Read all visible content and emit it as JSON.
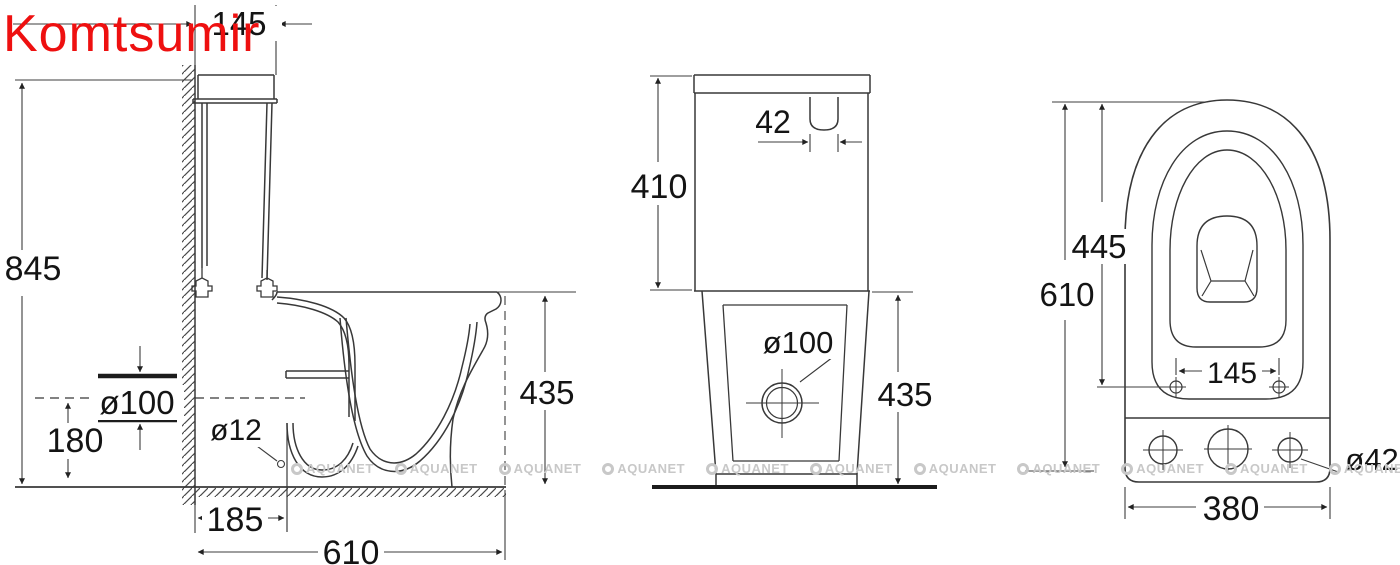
{
  "brand": {
    "name": "Komtsumir",
    "color": "#ee1010"
  },
  "watermark": {
    "text": "AQUANET",
    "icon": "circle-logo",
    "color": "#c8c8c8",
    "count": 11
  },
  "drawing": {
    "subject": "two-piece toilet technical drawing, three orthographic views",
    "units": "mm"
  },
  "side_view": {
    "dim_145": "145",
    "dim_845": "845",
    "dim_d100": "ø100",
    "dim_180": "180",
    "dim_d12": "ø12",
    "dim_185": "185",
    "dim_610": "610",
    "dim_435": "435"
  },
  "front_view": {
    "dim_410": "410",
    "dim_42": "42",
    "dim_d100": "ø100",
    "dim_435": "435"
  },
  "top_view": {
    "dim_445": "445",
    "dim_610": "610",
    "dim_145": "145",
    "dim_380": "380",
    "dim_d42": "ø42"
  }
}
